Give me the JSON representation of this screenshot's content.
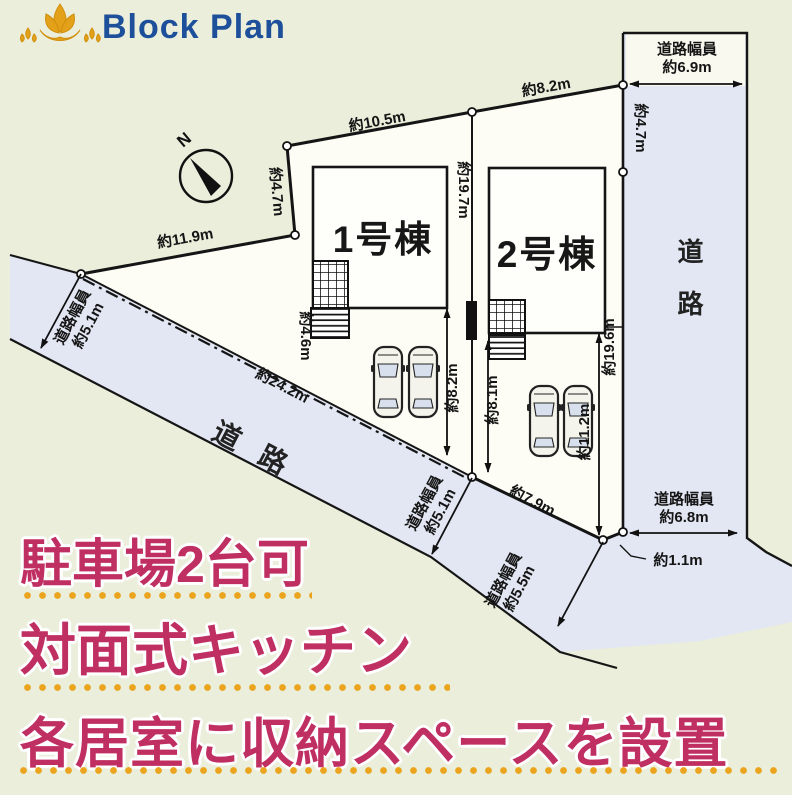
{
  "header": {
    "brand": "Block Plan"
  },
  "plan": {
    "north": "N",
    "buildings": [
      {
        "label": "1号棟"
      },
      {
        "label": "2号棟"
      }
    ],
    "roads": {
      "right": "道路",
      "bottom": "道路"
    },
    "dims": {
      "top1": "約10.5m",
      "top2": "約8.2m",
      "rightTop": "約4.7m",
      "rightLen": "約19.6m",
      "leftShort": "約4.7m",
      "leftEdge": "約11.9m",
      "bottomEdge": "約24.2m",
      "divide": "約19.7m",
      "approach1": "約4.6m",
      "park1": "約8.2m",
      "park2": "約8.1m",
      "lot2side": "約11.2m",
      "bottom2": "約7.9m",
      "jog": "約1.1m"
    },
    "roadWidths": {
      "right": {
        "label": "道路幅員",
        "value": "約6.9m"
      },
      "bottomRight": {
        "label": "道路幅員",
        "value": "約6.8m"
      },
      "left": {
        "label": "道路幅員",
        "value": "約5.1m"
      },
      "bottomLeft": {
        "label": "道路幅員",
        "value": "約5.1m"
      },
      "bottomMid": {
        "label": "道路幅員",
        "value": "約5.5m"
      }
    }
  },
  "features": [
    {
      "text": "駐車場2台可"
    },
    {
      "text": "対面式キッチン"
    },
    {
      "text": "各居室に収納スペースを設置"
    }
  ],
  "colors": {
    "accent_pink": "#c02f62",
    "dot_orange": "#eaa41d",
    "brand_blue": "#1d4f9a",
    "road_blue": "#e2e7f3",
    "background": "#eaeedb",
    "logo_gold": "#e2a118"
  }
}
